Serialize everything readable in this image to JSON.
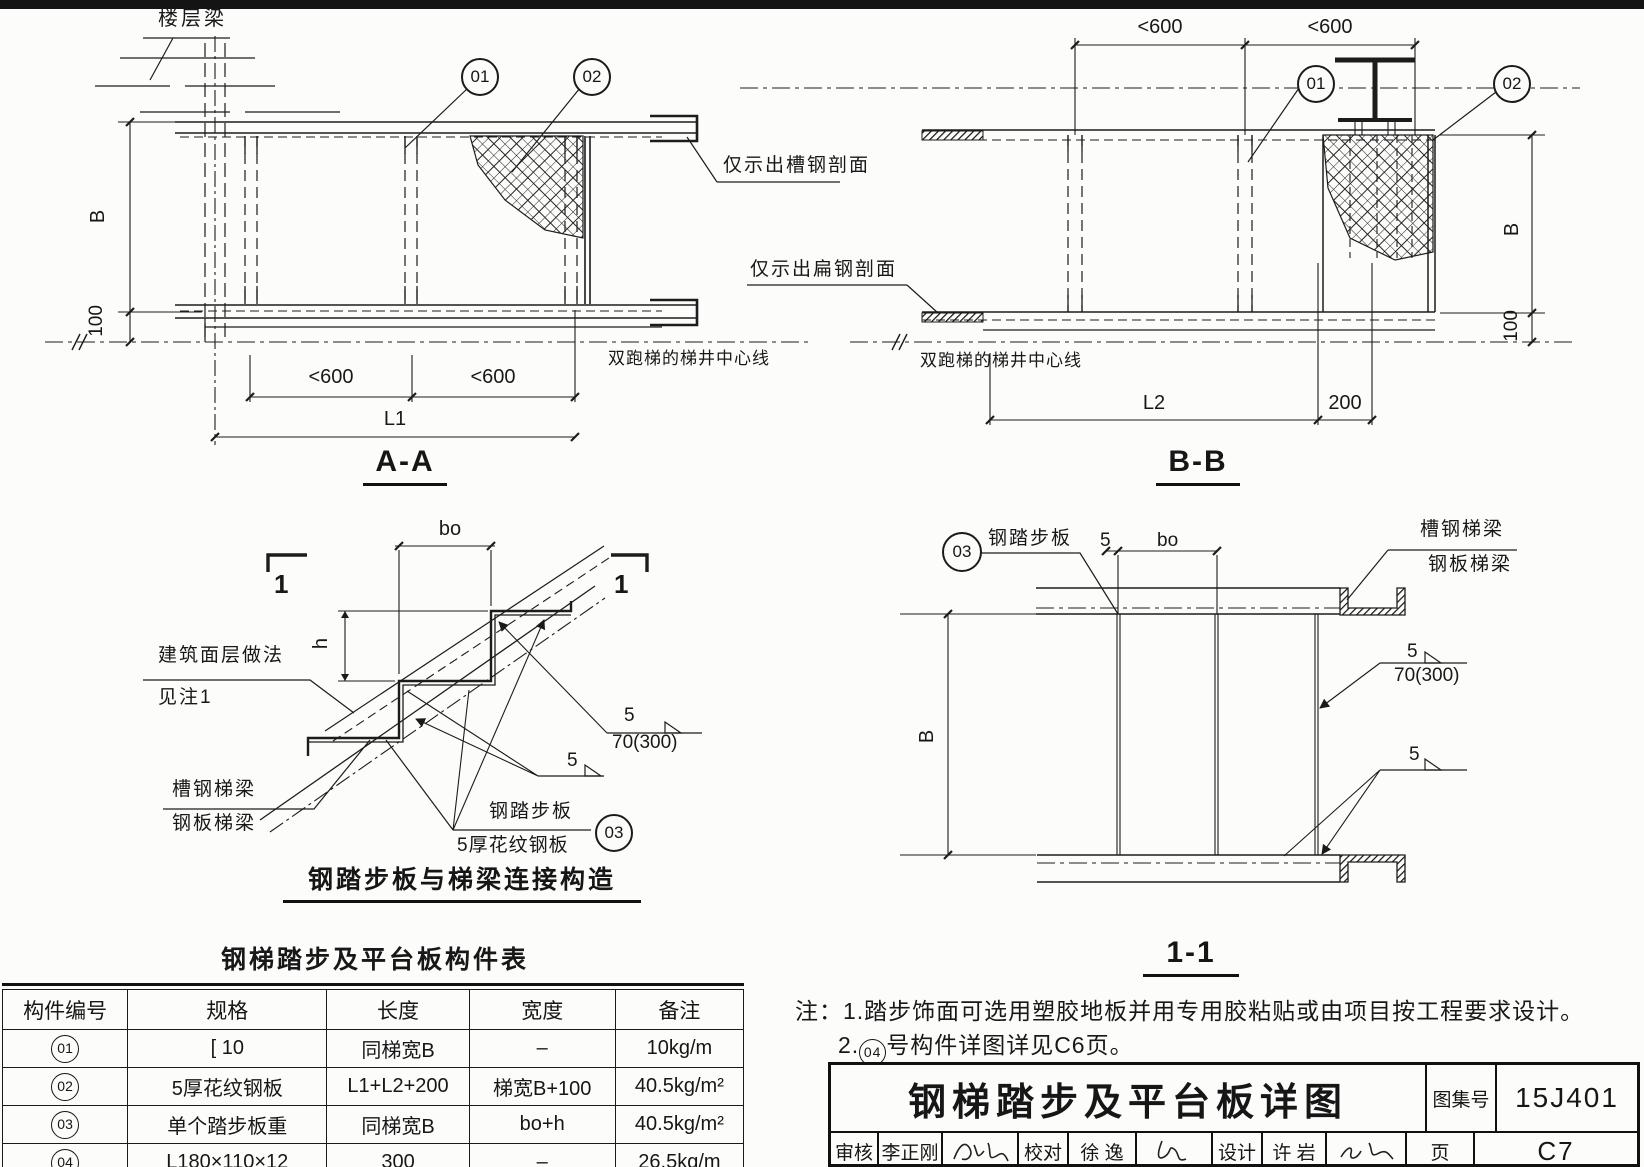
{
  "page": {
    "atlas_no": "15J401",
    "page_no": "C7"
  },
  "titles": {
    "section_aa": "A-A",
    "section_bb": "B-B",
    "section_11": "1-1",
    "detail": "钢踏步板与梯梁连接构造",
    "table": "钢梯踏步及平台板构件表",
    "sheet": "钢梯踏步及平台板详图"
  },
  "callouts": {
    "c01": "01",
    "c02": "02",
    "c03": "03",
    "sec1": "1"
  },
  "dims": {
    "lt600": "<600",
    "L1": "L1",
    "L2": "L2",
    "d200": "200",
    "B": "B",
    "d100": "100",
    "bo": "bo",
    "h": "h",
    "d5": "5",
    "weld": "70(300)"
  },
  "labels": {
    "floor_beam": "楼层梁",
    "channel_section_note": "仅示出槽钢剖面",
    "flat_steel_note": "仅示出扁钢剖面",
    "stair_well_centerline": "双跑梯的梯井中心线",
    "finish_line1": "建筑面层做法",
    "finish_line2": "见注1",
    "channel_stringer": "槽钢梯梁",
    "plate_stringer": "钢板梯梁",
    "tread_plate": "钢踏步板",
    "tread_plate_spec": "5厚花纹钢板"
  },
  "table": {
    "headers": [
      "构件编号",
      "规格",
      "长度",
      "宽度",
      "备注"
    ],
    "rows": [
      {
        "no": "01",
        "spec": "[ 10",
        "len": "同梯宽B",
        "wid": "–",
        "note": "10kg/m"
      },
      {
        "no": "02",
        "spec": "5厚花纹钢板",
        "len": "L1+L2+200",
        "wid": "梯宽B+100",
        "note": "40.5kg/m²"
      },
      {
        "no": "03",
        "spec": "单个踏步板重",
        "len": "同梯宽B",
        "wid": "bo+h",
        "note": "40.5kg/m²"
      },
      {
        "no": "04",
        "spec": "L180×110×12",
        "len": "300",
        "wid": "–",
        "note": "26.5kg/m"
      }
    ]
  },
  "notes": {
    "prefix": "注：",
    "line1": "1.踏步饰面可选用塑胶地板并用专用胶粘贴或由项目按工程要求设计。",
    "line2_pre": "2.",
    "line2_circle": "04",
    "line2_post": "号构件详图详见C6页。"
  },
  "titleblock": {
    "atlas_label": "图集号",
    "atlas_no": "15J401",
    "page_label": "页",
    "page_no": "C7",
    "review_label": "审核",
    "reviewer": "李正刚",
    "proof_label": "校对",
    "proofer": "徐 逸",
    "design_label": "设计",
    "designer": "许 岩"
  }
}
